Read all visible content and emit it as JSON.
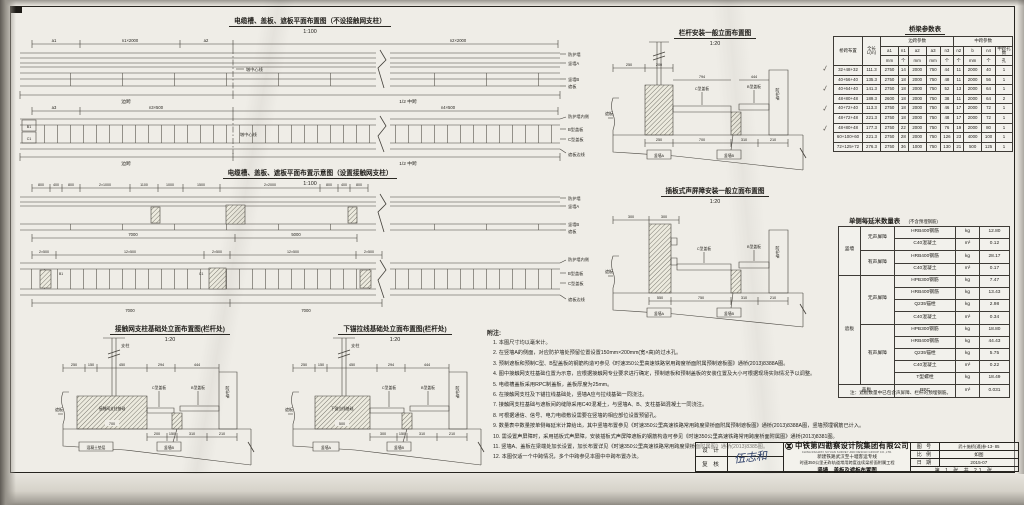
{
  "plan1": {
    "title": "电缆槽、盖板、遮板平面布置图（不设接触网支柱）",
    "scale": "1:100",
    "dims_top": [
      "a1",
      "n1×2000",
      "a2",
      "n2×2000"
    ],
    "labels_right": [
      "防护墙",
      "竖墙A",
      "竖墙B",
      "遮板"
    ],
    "label_center": "墩中心线",
    "span_left": "边跨",
    "span_right": "1/2 中跨"
  },
  "plan1b": {
    "dims_top": [
      "a3",
      "n3×500",
      "n4×500"
    ],
    "labels_right": [
      "防护墙内侧",
      "B型盖板",
      "C型盖板"
    ],
    "label_edge": "遮板边线",
    "label_center": "墩中心线",
    "span_left": "边跨",
    "span_right": "1/2 中跨",
    "end_units": [
      "B1",
      "C1"
    ]
  },
  "plan2": {
    "title": "电缆槽、盖板、遮板平面布置示意图（设置接触网支柱）",
    "scale": "1:100",
    "dims_top": [
      "800",
      "400",
      "800",
      "2×1000",
      "1100",
      "1000",
      "1500",
      "2×2000",
      "800",
      "400",
      "800"
    ],
    "dims_bottom": [
      "7000",
      "5000"
    ],
    "labels_right": [
      "防护墙",
      "竖墙A",
      "竖墙B",
      "遮板"
    ],
    "foundation_label": "接触网支柱基础"
  },
  "plan2b": {
    "dims_top": [
      "2×500",
      "12×500",
      "2×500",
      "12×500",
      "2×500"
    ],
    "dims_bottom": [
      "7000",
      "7000"
    ],
    "labels_right": [
      "防护墙内侧",
      "B型盖板",
      "C型盖板"
    ],
    "label_edge": "遮板边线",
    "end_units": [
      "B1",
      "C1"
    ]
  },
  "elev1": {
    "title": "栏杆安装一般立面布置图",
    "scale": "1:20",
    "dims_top": [
      "250",
      "200"
    ],
    "cover_c": "C型盖板",
    "cover_c_dim": "794",
    "cover_b": "B型盖板",
    "cover_b_dim": "444",
    "wall": "防护墙",
    "slab": "遮板",
    "dims_bottom": [
      "250",
      "700",
      "310",
      "210"
    ],
    "wallA": "竖墙A",
    "wallB": "竖墙B"
  },
  "elev2": {
    "title": "插板式声屏障安装一般立面布置图",
    "scale": "1:20",
    "dims_top": [
      "300",
      "300"
    ],
    "cover_c": "C型盖板",
    "cover_c_dim": "794",
    "cover_b": "B型盖板",
    "cover_b_dim": "444",
    "wall": "防护墙",
    "slab": "遮板",
    "dims_bottom": [
      "550",
      "750",
      "310",
      "210"
    ],
    "wallA": "竖墙A",
    "wallB": "竖墙B"
  },
  "detail1": {
    "title": "接触网支柱基础处立面布置图(栏杆处)",
    "scale": "1:20",
    "post": "支柱",
    "dims_top": [
      "250",
      "150",
      "450",
      "294",
      "444"
    ],
    "foundation": "接触网支柱基础",
    "foundation_dim": "700",
    "cover_c": "C型盖板",
    "cover_b": "B型盖板",
    "wall": "防护墙",
    "slab": "遮板",
    "dims_bottom": [
      "200",
      "150",
      "310",
      "210"
    ],
    "base_label": "混凝土垫层",
    "wallB": "竖墙B"
  },
  "detail2": {
    "title": "下锚拉线基础处立面布置图(栏杆处)",
    "scale": "1:20",
    "post": "支柱",
    "dims_top": [
      "250",
      "150",
      "450",
      "294",
      "444"
    ],
    "foundation": "下锚拉线基础",
    "foundation_dim": "500",
    "cover_c": "C型盖板",
    "cover_b": "B型盖板",
    "wall": "防护墙",
    "slab": "遮板",
    "dims_bottom": [
      "300",
      "150",
      "310",
      "210"
    ],
    "base_label": "竖墙A",
    "wallB": "竖墙B"
  },
  "bridge_table": {
    "title": "桥梁参数表",
    "h_span": "桥跨布置",
    "h_length": "全长L(m)",
    "h_side": "边跨参数",
    "h_mid": "中跨参数",
    "cols": [
      "a1",
      "n1",
      "a2",
      "a3",
      "n3",
      "n2",
      "b",
      "n4",
      "中跨孔数"
    ],
    "units": [
      "mm",
      "个",
      "mm",
      "mm",
      "个",
      "个",
      "mm",
      "个",
      "孔"
    ],
    "rows": [
      [
        "32+48+32",
        "111.3",
        "2750",
        "14",
        "2000",
        "750",
        "44",
        "11",
        "2000",
        "40",
        "1"
      ],
      [
        "40+56+40",
        "135.3",
        "2750",
        "18",
        "2000",
        "750",
        "48",
        "11",
        "2000",
        "56",
        "1"
      ],
      [
        "40+64+40",
        "141.3",
        "2750",
        "18",
        "2000",
        "750",
        "52",
        "13",
        "2000",
        "64",
        "1"
      ],
      [
        "48+80+48",
        "189.3",
        "2600",
        "18",
        "2000",
        "750",
        "38",
        "11",
        "2000",
        "64",
        "2"
      ],
      [
        "40+72+40",
        "113.3",
        "2750",
        "18",
        "2000",
        "750",
        "46",
        "17",
        "2000",
        "72",
        "1"
      ],
      [
        "48+72+48",
        "221.3",
        "2750",
        "18",
        "2000",
        "750",
        "48",
        "17",
        "2000",
        "72",
        "1"
      ],
      [
        "48+80+48",
        "177.3",
        "2750",
        "22",
        "2000",
        "750",
        "76",
        "19",
        "2000",
        "80",
        "1"
      ],
      [
        "60+100+60",
        "221.3",
        "2750",
        "28",
        "2000",
        "750",
        "126",
        "23",
        "4000",
        "100",
        "1"
      ],
      [
        "72+125+72",
        "276.3",
        "2750",
        "36",
        "1000",
        "750",
        "130",
        "21",
        "500",
        "125",
        "1"
      ]
    ]
  },
  "qty_table": {
    "title": "单侧每延米数量表",
    "subtitle": "(不含预埋钢筋)",
    "g1": "竖墙",
    "g2": "遮板",
    "g3": "盖板",
    "no_sb": "无声屏障",
    "with_sb": "有声屏障",
    "vr": [
      [
        "HRB400钢筋",
        "kg",
        "12.80"
      ],
      [
        "C40混凝土",
        "m³",
        "0.12"
      ],
      [
        "HRB400钢筋",
        "kg",
        "28.17"
      ],
      [
        "C40混凝土",
        "m³",
        "0.17"
      ]
    ],
    "sr": [
      [
        "HPB300钢筋",
        "kg",
        "7.47"
      ],
      [
        "HRB400钢筋",
        "kg",
        "13.43"
      ],
      [
        "Q235锚栓",
        "kg",
        "2.98"
      ],
      [
        "C40混凝土",
        "m³",
        "0.34"
      ],
      [
        "HPB300钢筋",
        "kg",
        "18.80"
      ],
      [
        "HRB400钢筋",
        "kg",
        "44.43"
      ],
      [
        "Q235锚栓",
        "kg",
        "5.75"
      ],
      [
        "C40混凝土",
        "m³",
        "0.22"
      ],
      [
        "T型螺栓",
        "kg",
        "18.49"
      ]
    ],
    "cr": [
      "RPC",
      "m³",
      "0.031"
    ],
    "footnote": "注：遮板数量中已包含声屏障、栏杆的预埋钢筋。"
  },
  "notes": {
    "title": "附注:",
    "items": [
      "1. 本图尺寸均以毫米计。",
      "2. 在竖墙A的侧面，对应防护墙处预留位置设置150mm×200mm(宽×高)的过水孔。",
      "3. 预制遮板和预制C型、B型盖板的钢筋构造可参见《时速350公里高速铁路常用跨度桥面附属预制遮板图》通桥(2013)8388A图。",
      "4. 图中接触网支柱基础位置为示意，应根据接触网专业要求进行确定，预制遮板和预制盖板的安装位置及大小可根据现场实际情况予以调整。",
      "5. 电缆槽盖板采用RPC制盖板，盖板厚度为25mm。",
      "6. 在接触网支柱及下锚拉线基础处，竖墙A应与拉线基础一同浇注。",
      "7. 接触网支柱基础与遮板间的缝隙采用C40混凝土，与竖墙A、B、支柱基础混凝土一同浇注。",
      "8. 可根据通信、信号、电力电缆敷设需要在竖墙的相应部位设置预留孔。",
      "9. 数量表中数量按单侧每延米计算给出，其中竖墙布置参见《时速350公里高速铁路常用跨度梁桥面附属预制遮板图》通桥(2013)8388A图，竖墙预埋钢筋已计入。",
      "10. 需设置声屏障时，采用插板式声屏障，安装插板式声屏障遮板的钢筋构造可参见《时速350公里高速铁路常用跨度桥面附属图》通桥(2013)8381图。",
      "11. 竖墙A、盖板在梁端处加长设置，加长布置详见《时速350公里高速铁路常用跨度梁桥面附属图》通桥(2013)8385图。",
      "12. 本图仅适一个中跨情况，多个中跨参见本图中中跨布置办法。"
    ]
  },
  "title_block": {
    "design_label": "设 计",
    "check_label": "复 核",
    "signature": "伍志和",
    "company": "中铁第四勘察设计院集团有限公司",
    "company_en": "CHINA RAILWAY SIYUAN SURVEY AND DESIGN GROUP CO.,LTD.",
    "project1": "新建铁路武汉至十堰客运专线",
    "project2": "时速350公里无砟轨道常用跨度连续梁桥面附属工程",
    "drawing_name": "竖墙、盖板及遮板布置图",
    "fig_label": "图 号",
    "fig_no": "武十施桥(通)参-13- 85",
    "scale_label": "比 例",
    "scale_val": "如图",
    "date_label": "日 期",
    "date_val": "2015-07",
    "sheet_info": "第 1 张 共 21 张"
  },
  "marks": {
    "check": "✓"
  }
}
